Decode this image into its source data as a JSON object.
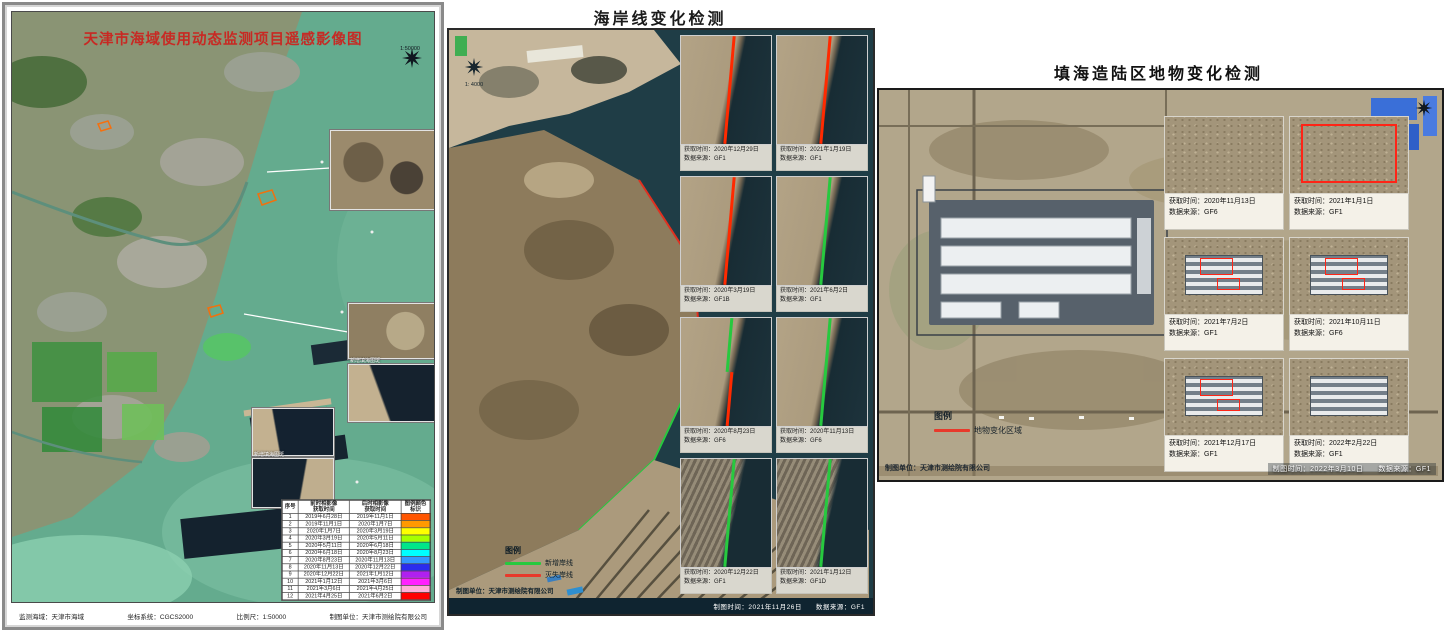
{
  "labels": {
    "acquired": "获取时间：",
    "source": "数据来源："
  },
  "left_panel": {
    "title": "天津市海域使用动态监测项目遥感影像图",
    "compass_scale": "1:50000",
    "inset_labels": [
      "新增填海图斑",
      "新增填海图斑"
    ],
    "legend_table": {
      "headers": [
        "序号",
        "前时相影像\n获取时间",
        "后时相影像\n获取时间",
        "图例颜色\n标识"
      ],
      "rows": [
        {
          "index": "1",
          "before": "2019年6月28日",
          "after": "2019年11月1日",
          "color": "#FF5500"
        },
        {
          "index": "2",
          "before": "2019年11月1日",
          "after": "2020年1月7日",
          "color": "#FF9900"
        },
        {
          "index": "3",
          "before": "2020年1月7日",
          "after": "2020年3月19日",
          "color": "#FFFF00"
        },
        {
          "index": "4",
          "before": "2020年3月19日",
          "after": "2020年5月11日",
          "color": "#A6FF00"
        },
        {
          "index": "5",
          "before": "2020年5月11日",
          "after": "2020年6月18日",
          "color": "#00E68A"
        },
        {
          "index": "6",
          "before": "2020年6月18日",
          "after": "2020年8月23日",
          "color": "#00FFFF"
        },
        {
          "index": "7",
          "before": "2020年8月23日",
          "after": "2020年11月13日",
          "color": "#3399FF"
        },
        {
          "index": "8",
          "before": "2020年11月13日",
          "after": "2020年12月22日",
          "color": "#2B2BEE"
        },
        {
          "index": "9",
          "before": "2020年12月22日",
          "after": "2021年1月12日",
          "color": "#B020F0"
        },
        {
          "index": "10",
          "before": "2021年1月12日",
          "after": "2021年3月6日",
          "color": "#FF22FF"
        },
        {
          "index": "11",
          "before": "2021年3月6日",
          "after": "2021年4月25日",
          "color": "#FFB0D8"
        },
        {
          "index": "12",
          "before": "2021年4月25日",
          "after": "2021年6月2日",
          "color": "#FF0000"
        }
      ]
    },
    "footer": {
      "area": "监测海域：天津市海域",
      "coords": "坐标系统：CGCS2000",
      "scale": "比例尺：1:50000",
      "credit": "制图单位：天津市测绘院有限公司"
    }
  },
  "middle_panel": {
    "title": "海岸线变化检测",
    "scale_label": "1: 4000",
    "insets": [
      {
        "time": "2020年12月29日",
        "source": "GF1",
        "line_colors": [
          "#ff2a00"
        ],
        "stripes": false
      },
      {
        "time": "2021年1月19日",
        "source": "GF1",
        "line_colors": [
          "#ff2a00"
        ],
        "stripes": false
      },
      {
        "time": "2020年3月19日",
        "source": "GF1B",
        "line_colors": [
          "#ff2a00"
        ],
        "stripes": false
      },
      {
        "time": "2021年6月2日",
        "source": "GF1",
        "line_colors": [
          "#27c93f"
        ],
        "stripes": false
      },
      {
        "time": "2020年8月23日",
        "source": "GF6",
        "line_colors": [
          "#27c93f",
          "#ff2a00"
        ],
        "stripes": false
      },
      {
        "time": "2020年11月13日",
        "source": "GF6",
        "line_colors": [
          "#27c93f"
        ],
        "stripes": false
      },
      {
        "time": "2020年12月22日",
        "source": "GF1",
        "line_colors": [
          "#27c93f"
        ],
        "stripes": true
      },
      {
        "time": "2021年1月12日",
        "source": "GF1D",
        "line_colors": [
          "#27c93f"
        ],
        "stripes": true
      }
    ],
    "legend": {
      "title": "图例",
      "items": [
        {
          "label": "新增岸线",
          "color": "#27c93f"
        },
        {
          "label": "灭失岸线",
          "color": "#e8392b"
        }
      ]
    },
    "credit": "制图单位：天津市测绘院有限公司",
    "footer": "制图时间：2021年11月26日　　数据来源：GF1"
  },
  "right_panel": {
    "title": "填海造陆区地物变化检测",
    "insets": [
      {
        "time": "2020年11月13日",
        "source": "GF6",
        "bg": "bare",
        "overlay": "none"
      },
      {
        "time": "2021年1月1日",
        "source": "GF1",
        "bg": "bare",
        "overlay": "rect"
      },
      {
        "time": "2021年7月2日",
        "source": "GF1",
        "bg": "facility",
        "overlay": "marks"
      },
      {
        "time": "2021年10月11日",
        "source": "GF6",
        "bg": "facility",
        "overlay": "marks"
      },
      {
        "time": "2021年12月17日",
        "source": "GF1",
        "bg": "facility",
        "overlay": "marks"
      },
      {
        "time": "2022年2月22日",
        "source": "GF1",
        "bg": "facility",
        "overlay": "none"
      }
    ],
    "legend": {
      "title": "图例",
      "items": [
        {
          "label": "地物变化区域",
          "color": "#e8392b"
        }
      ]
    },
    "credit": "制图单位：天津市测绘院有限公司",
    "footer": "制图时间：2022年3月10日　　数据来源：GF1"
  }
}
